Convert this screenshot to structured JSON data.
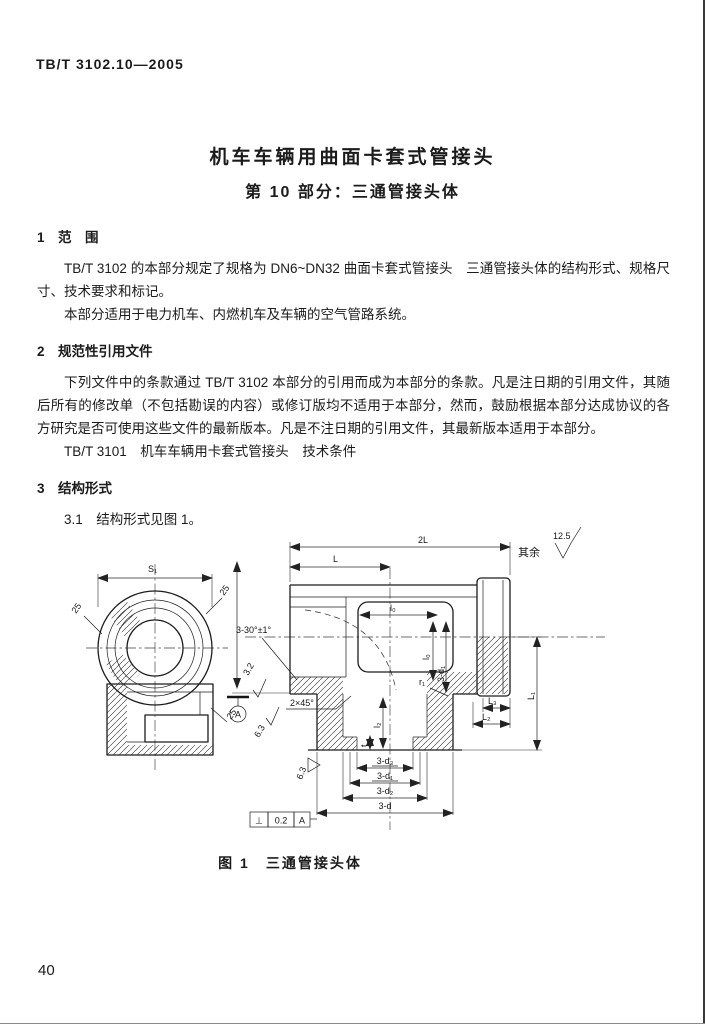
{
  "page": {
    "standard_code": "TB/T 3102.10—2005",
    "page_number": "40"
  },
  "title": {
    "line1": "机车车辆用曲面卡套式管接头",
    "line2": "第 10 部分：三通管接头体"
  },
  "sections": {
    "s1": {
      "heading": "1　范　围",
      "p1": "TB/T 3102 的本部分规定了规格为 DN6~DN32 曲面卡套式管接头　三通管接头体的结构形式、规格尺寸、技术要求和标记。",
      "p2": "本部分适用于电力机车、内燃机车及车辆的空气管路系统。"
    },
    "s2": {
      "heading": "2　规范性引用文件",
      "p1": "下列文件中的条款通过 TB/T 3102 本部分的引用而成为本部分的条款。凡是注日期的引用文件，其随后所有的修改单（不包括勘误的内容）或修订版均不适用于本部分，然而，鼓励根据本部分达成协议的各方研究是否可使用这些文件的最新版本。凡是不注日期的引用文件，其最新版本适用于本部分。",
      "ref": "TB/T 3101　机车车辆用卡套式管接头　技术条件"
    },
    "s3": {
      "heading": "3　结构形式",
      "p31": "3.1　结构形式见图 1。"
    }
  },
  "figure": {
    "caption": "图 1　三通管接头体",
    "roughness_note": {
      "prefix": "其余",
      "value": "12.5"
    },
    "labels": {
      "s1_dim": "S₁",
      "rough_left": "25",
      "rough_upper": "25",
      "rough_lower": "25",
      "dim_2l": "2L",
      "dim_l": "L",
      "dim_l0": "l₀",
      "dim_l0_v": "l₀",
      "dim_3d1_v": "3-d₁",
      "angle": "3-30°±1°",
      "rough_32": "3.2",
      "chamfer": "2×45°",
      "rough_63_a": "6.3",
      "rough_63_b": "6.3",
      "datum": "A",
      "r1": "r₁",
      "dim_l2_small": "l₂",
      "dim_t": "t",
      "dim_L3": "L₃",
      "dim_L2": "L₂",
      "dim_L1": "L₁",
      "dim_d3": "3-d₃",
      "dim_d1": "3-d₁",
      "dim_d2": "3-d₂",
      "dim_d": "3-d"
    },
    "tolerance": {
      "symbol": "⊥",
      "value": "0.2",
      "datum": "A"
    }
  }
}
